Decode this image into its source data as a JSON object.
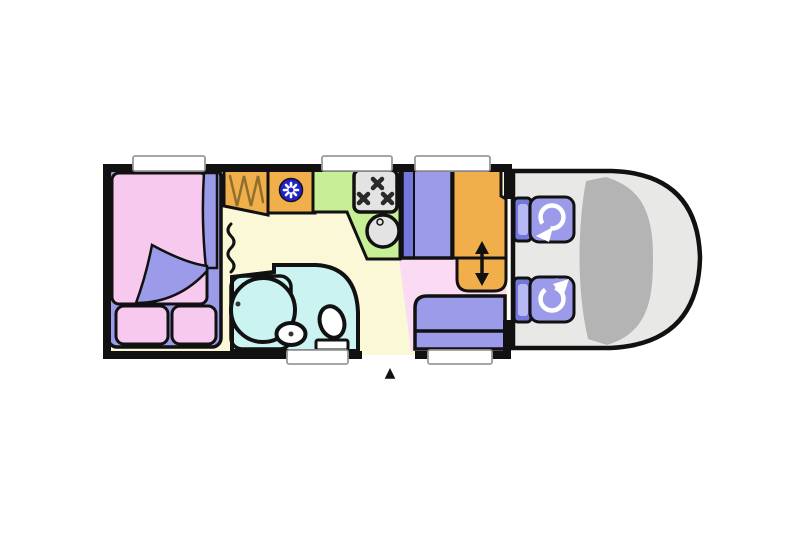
{
  "diagram": {
    "kind": "motorhome-floor-plan",
    "door_marker": "▲",
    "components": {
      "bedroom": "double-bed with folded duvet and two pillows",
      "wardrobe": "hanging wardrobe",
      "heater": "blower heater",
      "kitchen": "kitchen unit with 3-burner hob and round sink",
      "fridge": "tall fridge unit",
      "table": "sliding dinette table",
      "bench": "dinette bench seat",
      "bathroom": "washroom with shower, basin and toilet",
      "curtain": "divider curtain",
      "cab": "driver cab with two swivel seats",
      "entrance": "entrance door marker"
    },
    "colors": {
      "wall": "#111111",
      "cream": "#faf8d6",
      "pink_floor": "#fbdaf3",
      "bath_cyan": "#cbf3f1",
      "orange": "#f1af4b",
      "purple": "#9b9bea",
      "purple_dark": "#7478dc",
      "bed_pink": "#f8c9ef",
      "green": "#c6ef96",
      "appliance": "#e3e3e3",
      "fan_blue": "#2222cc",
      "cab_gray": "#e8e8e6",
      "windshield_gray": "#b4b4b4",
      "window_white": "#ffffff",
      "hanger_brown": "#8f6f2f",
      "white": "#ffffff",
      "burner_dark": "#2a2a2a"
    }
  }
}
